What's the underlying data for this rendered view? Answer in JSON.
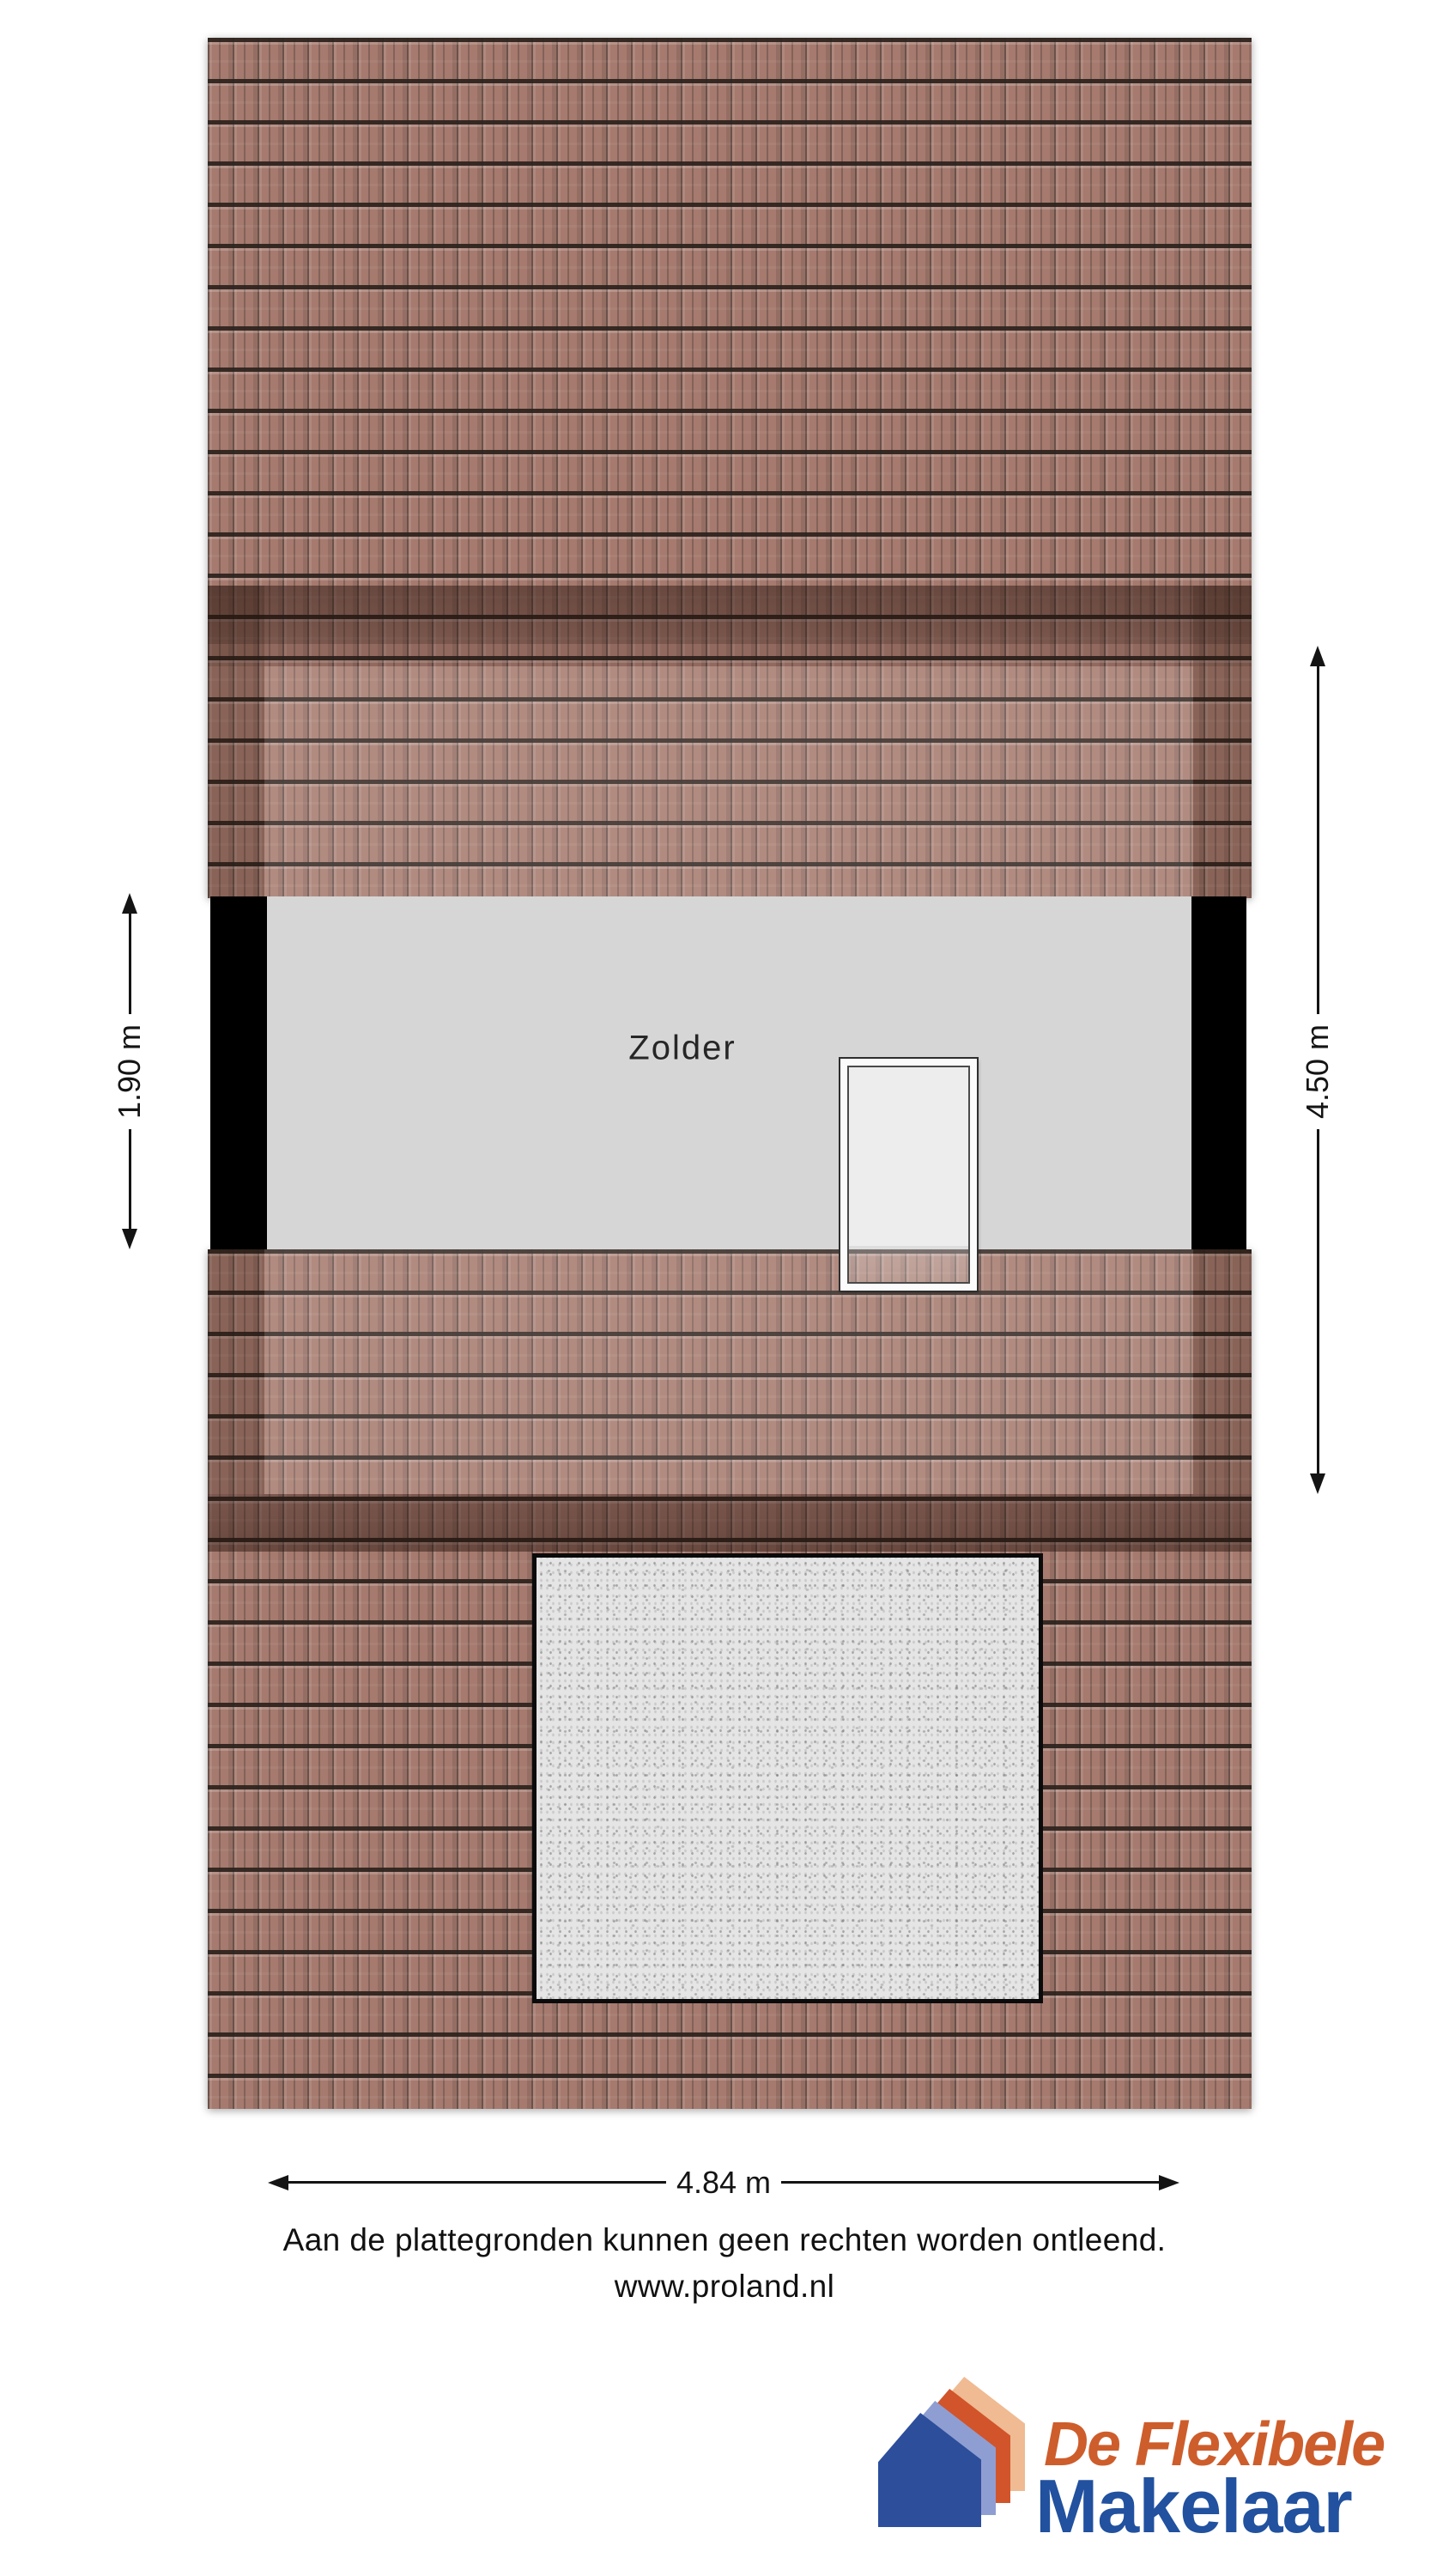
{
  "plan": {
    "room_label": "Zolder",
    "dimensions": {
      "left": "1.90 m",
      "right": "4.50 m",
      "bottom": "4.84 m"
    },
    "colors": {
      "tile_base": "#a67a6e",
      "tile_ridge": "#2c221d",
      "dormer_shade": "rgba(35,16,10,0.45)",
      "floor": "#d6d6d6",
      "wall": "#000000",
      "concrete": "#e5e5e5",
      "door_fill": "#ededed",
      "dimension_ink": "#141414"
    }
  },
  "footer": {
    "disclaimer": "Aan de plattegronden kunnen geen rechten worden ontleend.",
    "website": "www.proland.nl"
  },
  "logo": {
    "line1": "De Flexibele",
    "line2": "Makelaar",
    "colors": {
      "house_blue": "#2C4E9B",
      "house_periwinkle": "#8F9ED2",
      "house_orange": "#D2542A",
      "house_peach": "#F0BA92",
      "text_orange": "#CE5D2C",
      "text_blue": "#21519F"
    }
  }
}
